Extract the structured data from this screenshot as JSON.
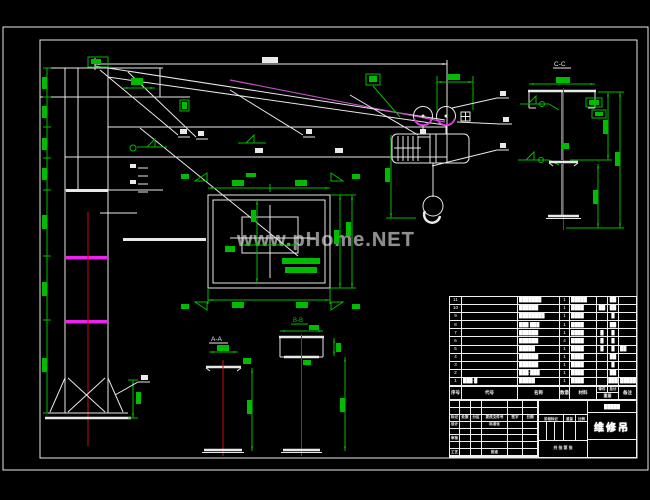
{
  "watermark": {
    "text": "www.pHome.NET",
    "color": "#8f8f8f"
  },
  "colors": {
    "background": "#000000",
    "line_white": "#e9e9e9",
    "dimension_green": "#00bb00",
    "centerline_red": "#cc1111",
    "highlight_magenta": "#ee22ee",
    "tie_rod_violet": "#c34fc3"
  },
  "drawing": {
    "title": "维修吊",
    "sections": {
      "a": "A-A",
      "b": "B-B",
      "c": "C-C"
    }
  },
  "bom": {
    "headers": {
      "seq": "序号",
      "code": "代号",
      "name": "名称",
      "qty": "数量",
      "mat": "材料",
      "w1": "单件",
      "w2": "总计",
      "weight": "重量",
      "note": "备注"
    },
    "rows": [
      {
        "seq": "11",
        "code": "",
        "name": "███████",
        "qty": "1",
        "mat": "█████",
        "w1": "",
        "w2": "██",
        "note": ""
      },
      {
        "seq": "10",
        "code": "",
        "name": "██████",
        "qty": "1",
        "mat": "████",
        "w1": "██",
        "w2": "██",
        "note": ""
      },
      {
        "seq": "9",
        "code": "",
        "name": "████████",
        "qty": "1",
        "mat": "████",
        "w1": "",
        "w2": "█",
        "note": ""
      },
      {
        "seq": "8",
        "code": "",
        "name": "███ ███",
        "qty": "1",
        "mat": "████",
        "w1": "",
        "w2": "██",
        "note": ""
      },
      {
        "seq": "7",
        "code": "",
        "name": "██████",
        "qty": "1",
        "mat": "████",
        "w1": "█",
        "w2": "█",
        "note": ""
      },
      {
        "seq": "6",
        "code": "",
        "name": "██████",
        "qty": "4",
        "mat": "████",
        "w1": "█",
        "w2": "█",
        "note": ""
      },
      {
        "seq": "5",
        "code": "",
        "name": "█████",
        "qty": "1",
        "mat": "████",
        "w1": "█",
        "w2": "█",
        "note": "██"
      },
      {
        "seq": "4",
        "code": "",
        "name": "██████",
        "qty": "1",
        "mat": "████",
        "w1": "",
        "w2": "██",
        "note": ""
      },
      {
        "seq": "3",
        "code": "",
        "name": "██████",
        "qty": "1",
        "mat": "████",
        "w1": "",
        "w2": "█",
        "note": ""
      },
      {
        "seq": "2",
        "code": "",
        "name": "███-███",
        "qty": "1",
        "mat": "████",
        "w1": "",
        "w2": "██",
        "note": ""
      },
      {
        "seq": "1",
        "code": "███-█",
        "name": "█████",
        "qty": "1",
        "mat": "████",
        "w1": "",
        "w2": "███",
        "note": "██████"
      }
    ]
  },
  "title_block": {
    "name": "维修吊",
    "company": "█████",
    "labels": {
      "mark": "标记",
      "count": "处数",
      "zone": "分区",
      "doc_no": "更改文件号",
      "sign": "签字",
      "date": "日期",
      "design": "设计",
      "standard": "标准化",
      "check": "审核",
      "process": "工艺",
      "approve": "批准",
      "stage": "阶段标记",
      "weight": "重量",
      "scale": "比例",
      "sheets": "共 张 第 张"
    }
  }
}
